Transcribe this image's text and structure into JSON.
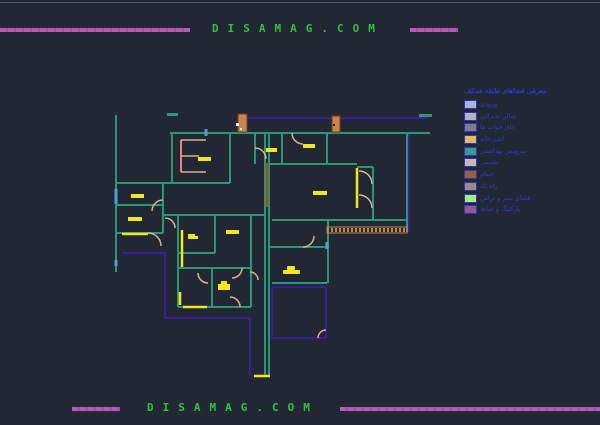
{
  "page": {
    "background": "#212833",
    "topline_color": "#4d535c"
  },
  "header": {
    "site_text": "DISAMAG.COM",
    "text_color": "#2fc23c",
    "bar_color": "#b55cb8"
  },
  "footer": {
    "site_text": "DISAMAG.COM"
  },
  "legend": {
    "title": "معرفی فضاهای طبقه همکف",
    "text_color": "#2b3ad0",
    "border_color": "#2a35c8",
    "items": [
      {
        "label": "ورودی",
        "color": "#a9b7e3"
      },
      {
        "label": "سالن پذیرایی",
        "color": "#b3b3c3"
      },
      {
        "label": "اتاق خواب ها",
        "color": "#7e7e8a"
      },
      {
        "label": "آشپزخانه",
        "color": "#e7ba62"
      },
      {
        "label": "سرویس بهداشتی",
        "color": "#3b9a8b"
      },
      {
        "label": "نشیمن",
        "color": "#c2bab0"
      },
      {
        "label": "حمام",
        "color": "#96603a"
      },
      {
        "label": "راه پله",
        "color": "#9a8c80"
      },
      {
        "label": "فضای سبز و تراس",
        "color": "#a4ef7d"
      },
      {
        "label": "پارکینگ و حیاط",
        "color": "#9c5492"
      }
    ]
  },
  "plan": {
    "wall_color": "#2e9678",
    "boundary_color": "#3a1c9c",
    "label_color": "#f2e61e",
    "door_color": "#d9b38c",
    "window_color": "#5b9bd5",
    "stair_color": "#e8837a",
    "column_color": "#c8854f",
    "ramp_color": "#8b5a2b"
  }
}
